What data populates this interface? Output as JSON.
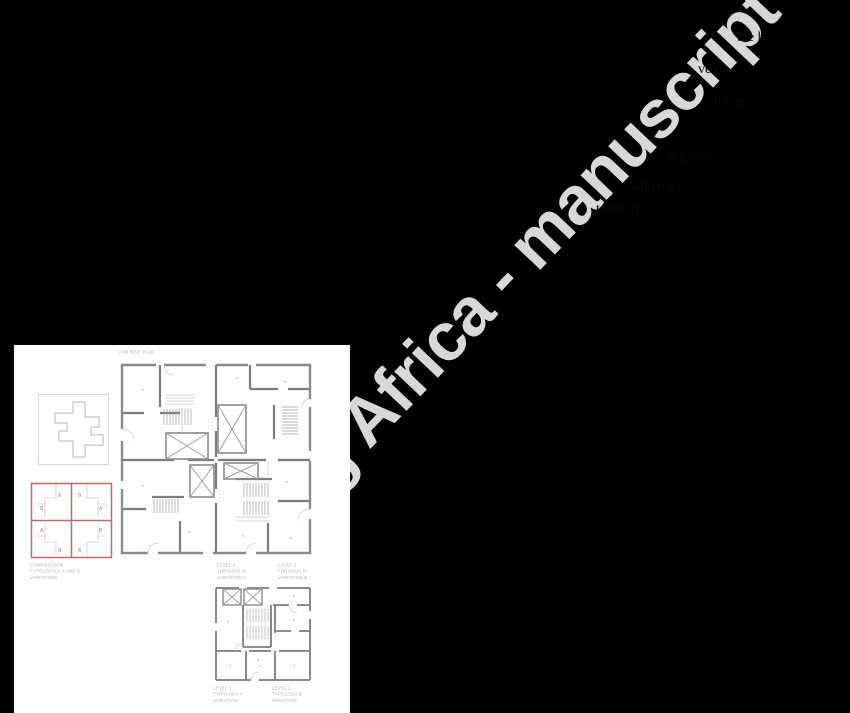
{
  "watermark": {
    "text": "ng Africa - manuscript",
    "color": "#d8d8d8"
  },
  "fragments": [
    {
      "text": "the h"
    },
    {
      "text": "ve c"
    },
    {
      "text": "d a pr"
    },
    {
      "text": "ing a co"
    },
    {
      "text": "and o g"
    },
    {
      "text": "to the g"
    }
  ],
  "figure": {
    "top_label": "LOW RISE PLAN",
    "composition": {
      "caption_lines": [
        "Composition",
        "Typologies A and B",
        "Variations"
      ],
      "unit_labels": {
        "a": "A",
        "b": "B"
      },
      "accent_color": "#c4695c"
    },
    "upper_plan_captions": {
      "left": [
        "Level 2",
        "Through N",
        "Variation A"
      ],
      "right": [
        "Level 2",
        "Through N",
        "Variation B"
      ]
    },
    "ground_plan_captions": {
      "left": [
        "Level 1",
        "Typology A",
        "Variation"
      ],
      "right": [
        "Level 1",
        "Typology B",
        "Variation"
      ]
    },
    "colors": {
      "panel": "#ffffff",
      "background": "#000000",
      "wall": "#8a8a8a",
      "detail": "#bdbdbd",
      "caption": "#aeaeae"
    }
  }
}
